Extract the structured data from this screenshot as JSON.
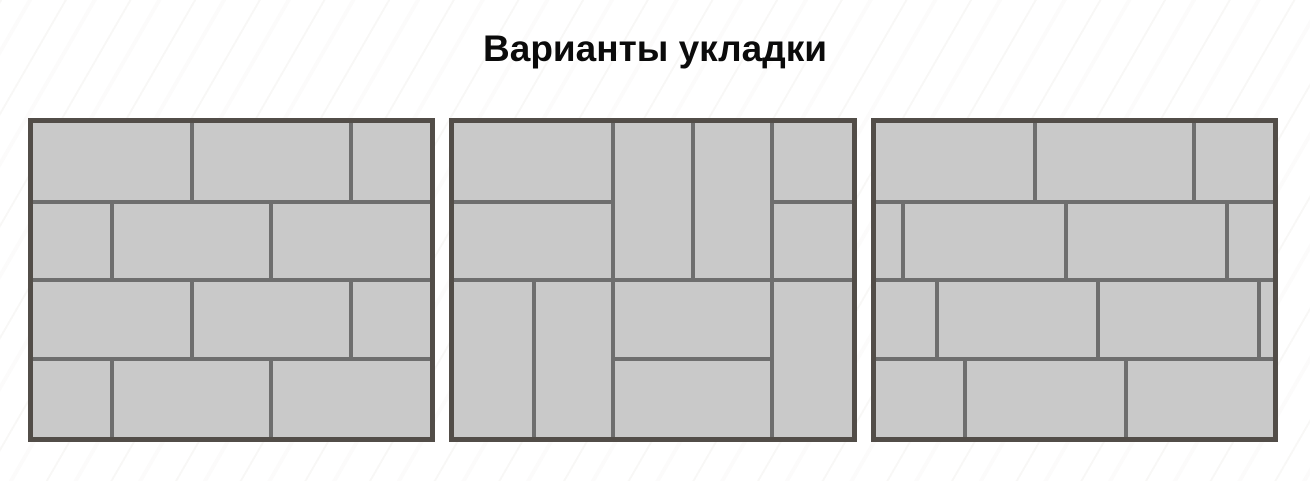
{
  "title": "Варианты укладки",
  "colors": {
    "page_background": "#ffffff",
    "brick_fill": "#c9c9c9",
    "joint_line": "#6e6e6e",
    "outer_border": "#524d48"
  },
  "patterns": [
    {
      "id": "half-offset-running-bond",
      "bricks": [
        {
          "x": 0,
          "y": 0,
          "w": 40,
          "h": 25
        },
        {
          "x": 40,
          "y": 0,
          "w": 40,
          "h": 25
        },
        {
          "x": 80,
          "y": 0,
          "w": 20,
          "h": 25
        },
        {
          "x": 0,
          "y": 25,
          "w": 20,
          "h": 25
        },
        {
          "x": 20,
          "y": 25,
          "w": 40,
          "h": 25
        },
        {
          "x": 60,
          "y": 25,
          "w": 40,
          "h": 25
        },
        {
          "x": 0,
          "y": 50,
          "w": 40,
          "h": 25
        },
        {
          "x": 40,
          "y": 50,
          "w": 40,
          "h": 25
        },
        {
          "x": 80,
          "y": 50,
          "w": 20,
          "h": 25
        },
        {
          "x": 0,
          "y": 75,
          "w": 20,
          "h": 25
        },
        {
          "x": 20,
          "y": 75,
          "w": 40,
          "h": 25
        },
        {
          "x": 60,
          "y": 75,
          "w": 40,
          "h": 25
        }
      ]
    },
    {
      "id": "pinwheel-basketweave",
      "bricks": [
        {
          "x": 0,
          "y": 0,
          "w": 40,
          "h": 25
        },
        {
          "x": 0,
          "y": 25,
          "w": 40,
          "h": 25
        },
        {
          "x": 40,
          "y": 0,
          "w": 20,
          "h": 50
        },
        {
          "x": 60,
          "y": 0,
          "w": 20,
          "h": 50
        },
        {
          "x": 80,
          "y": 0,
          "w": 20,
          "h": 25
        },
        {
          "x": 80,
          "y": 25,
          "w": 20,
          "h": 25
        },
        {
          "x": 0,
          "y": 50,
          "w": 20,
          "h": 50
        },
        {
          "x": 20,
          "y": 50,
          "w": 20,
          "h": 50
        },
        {
          "x": 40,
          "y": 50,
          "w": 40,
          "h": 25
        },
        {
          "x": 40,
          "y": 75,
          "w": 40,
          "h": 25
        },
        {
          "x": 80,
          "y": 50,
          "w": 20,
          "h": 50
        }
      ]
    },
    {
      "id": "fifth-offset-running-bond",
      "bricks": [
        {
          "x": 0,
          "y": 0,
          "w": 40,
          "h": 25
        },
        {
          "x": 40,
          "y": 0,
          "w": 40,
          "h": 25
        },
        {
          "x": 80,
          "y": 0,
          "w": 20,
          "h": 25
        },
        {
          "x": 0,
          "y": 25,
          "w": 7,
          "h": 25
        },
        {
          "x": 7,
          "y": 25,
          "w": 41,
          "h": 25
        },
        {
          "x": 48,
          "y": 25,
          "w": 40.5,
          "h": 25
        },
        {
          "x": 88.5,
          "y": 25,
          "w": 11.5,
          "h": 25
        },
        {
          "x": 0,
          "y": 50,
          "w": 15.5,
          "h": 25
        },
        {
          "x": 15.5,
          "y": 50,
          "w": 40.5,
          "h": 25
        },
        {
          "x": 56,
          "y": 50,
          "w": 40.5,
          "h": 25
        },
        {
          "x": 96.5,
          "y": 50,
          "w": 3.5,
          "h": 25
        },
        {
          "x": 0,
          "y": 75,
          "w": 22.5,
          "h": 25
        },
        {
          "x": 22.5,
          "y": 75,
          "w": 40.5,
          "h": 25
        },
        {
          "x": 63,
          "y": 75,
          "w": 37,
          "h": 25
        }
      ]
    }
  ]
}
